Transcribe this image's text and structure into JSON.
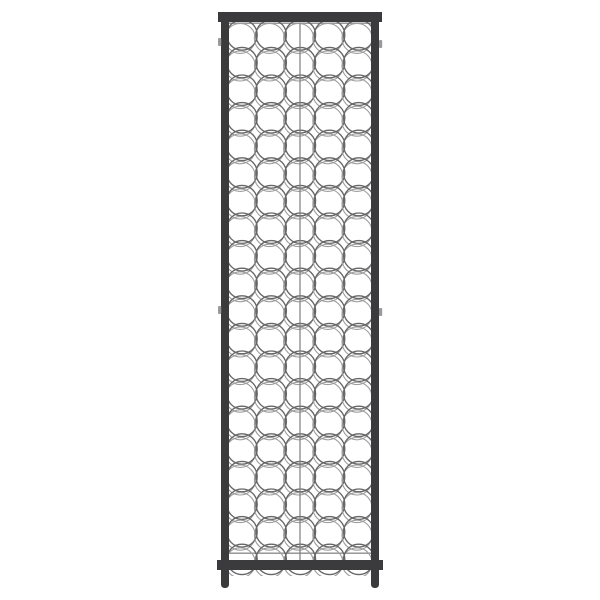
{
  "scene": {
    "description": "Product photograph of a tall narrow black metal wine rack with circular wire bottle slots, centered on a plain white background",
    "background_color": "#ffffff"
  },
  "rack": {
    "columns": 5,
    "rows": 20,
    "slot_count": 100,
    "frame_color": "#3b3b3d",
    "wire_color_front": "#666666",
    "wire_color_back": "#9d9d9d",
    "seam_color": "#7d7d7d",
    "rail_color": "#8f8f8f",
    "tab_color": "#9a9a9a",
    "geometry": {
      "canvas_w": 600,
      "canvas_h": 600,
      "top_bar": {
        "x": 218,
        "y": 12,
        "w": 164,
        "h": 10
      },
      "bottom_bar": {
        "x": 217,
        "y": 560,
        "w": 166,
        "h": 10
      },
      "left_bar": {
        "x": 221,
        "y": 22,
        "w": 8,
        "h": 540
      },
      "right_bar": {
        "x": 371,
        "y": 22,
        "w": 8,
        "h": 540
      },
      "left_leg": {
        "x": 221,
        "y": 566,
        "w": 8,
        "h": 22
      },
      "right_leg": {
        "x": 371,
        "y": 566,
        "w": 8,
        "h": 22
      },
      "leg_tip_radius": 3.5,
      "tabs": [
        {
          "x": 218,
          "y": 38
        },
        {
          "x": 379,
          "y": 40
        },
        {
          "x": 218,
          "y": 306
        },
        {
          "x": 379,
          "y": 308
        }
      ],
      "tab_w": 3.2,
      "tab_h": 8,
      "grid": {
        "start_x": 242,
        "start_y": 35,
        "col_spacing": 29.2,
        "row_spacing": 27.6,
        "radius": 15.2,
        "stroke_front": 1.35,
        "echo_dx": -1.8,
        "echo_dy": 3.4,
        "echo_radius": 15.0,
        "stroke_back": 1.1
      },
      "clip": {
        "x": 228.5,
        "y": 22,
        "w": 143,
        "h": 554
      },
      "seam": {
        "x": 300,
        "y1": 23,
        "y2": 560,
        "width": 1.2
      },
      "rails": [
        {
          "y": 22.5,
          "h": 1.4
        },
        {
          "y": 552.5,
          "h": 1.4
        }
      ]
    }
  }
}
